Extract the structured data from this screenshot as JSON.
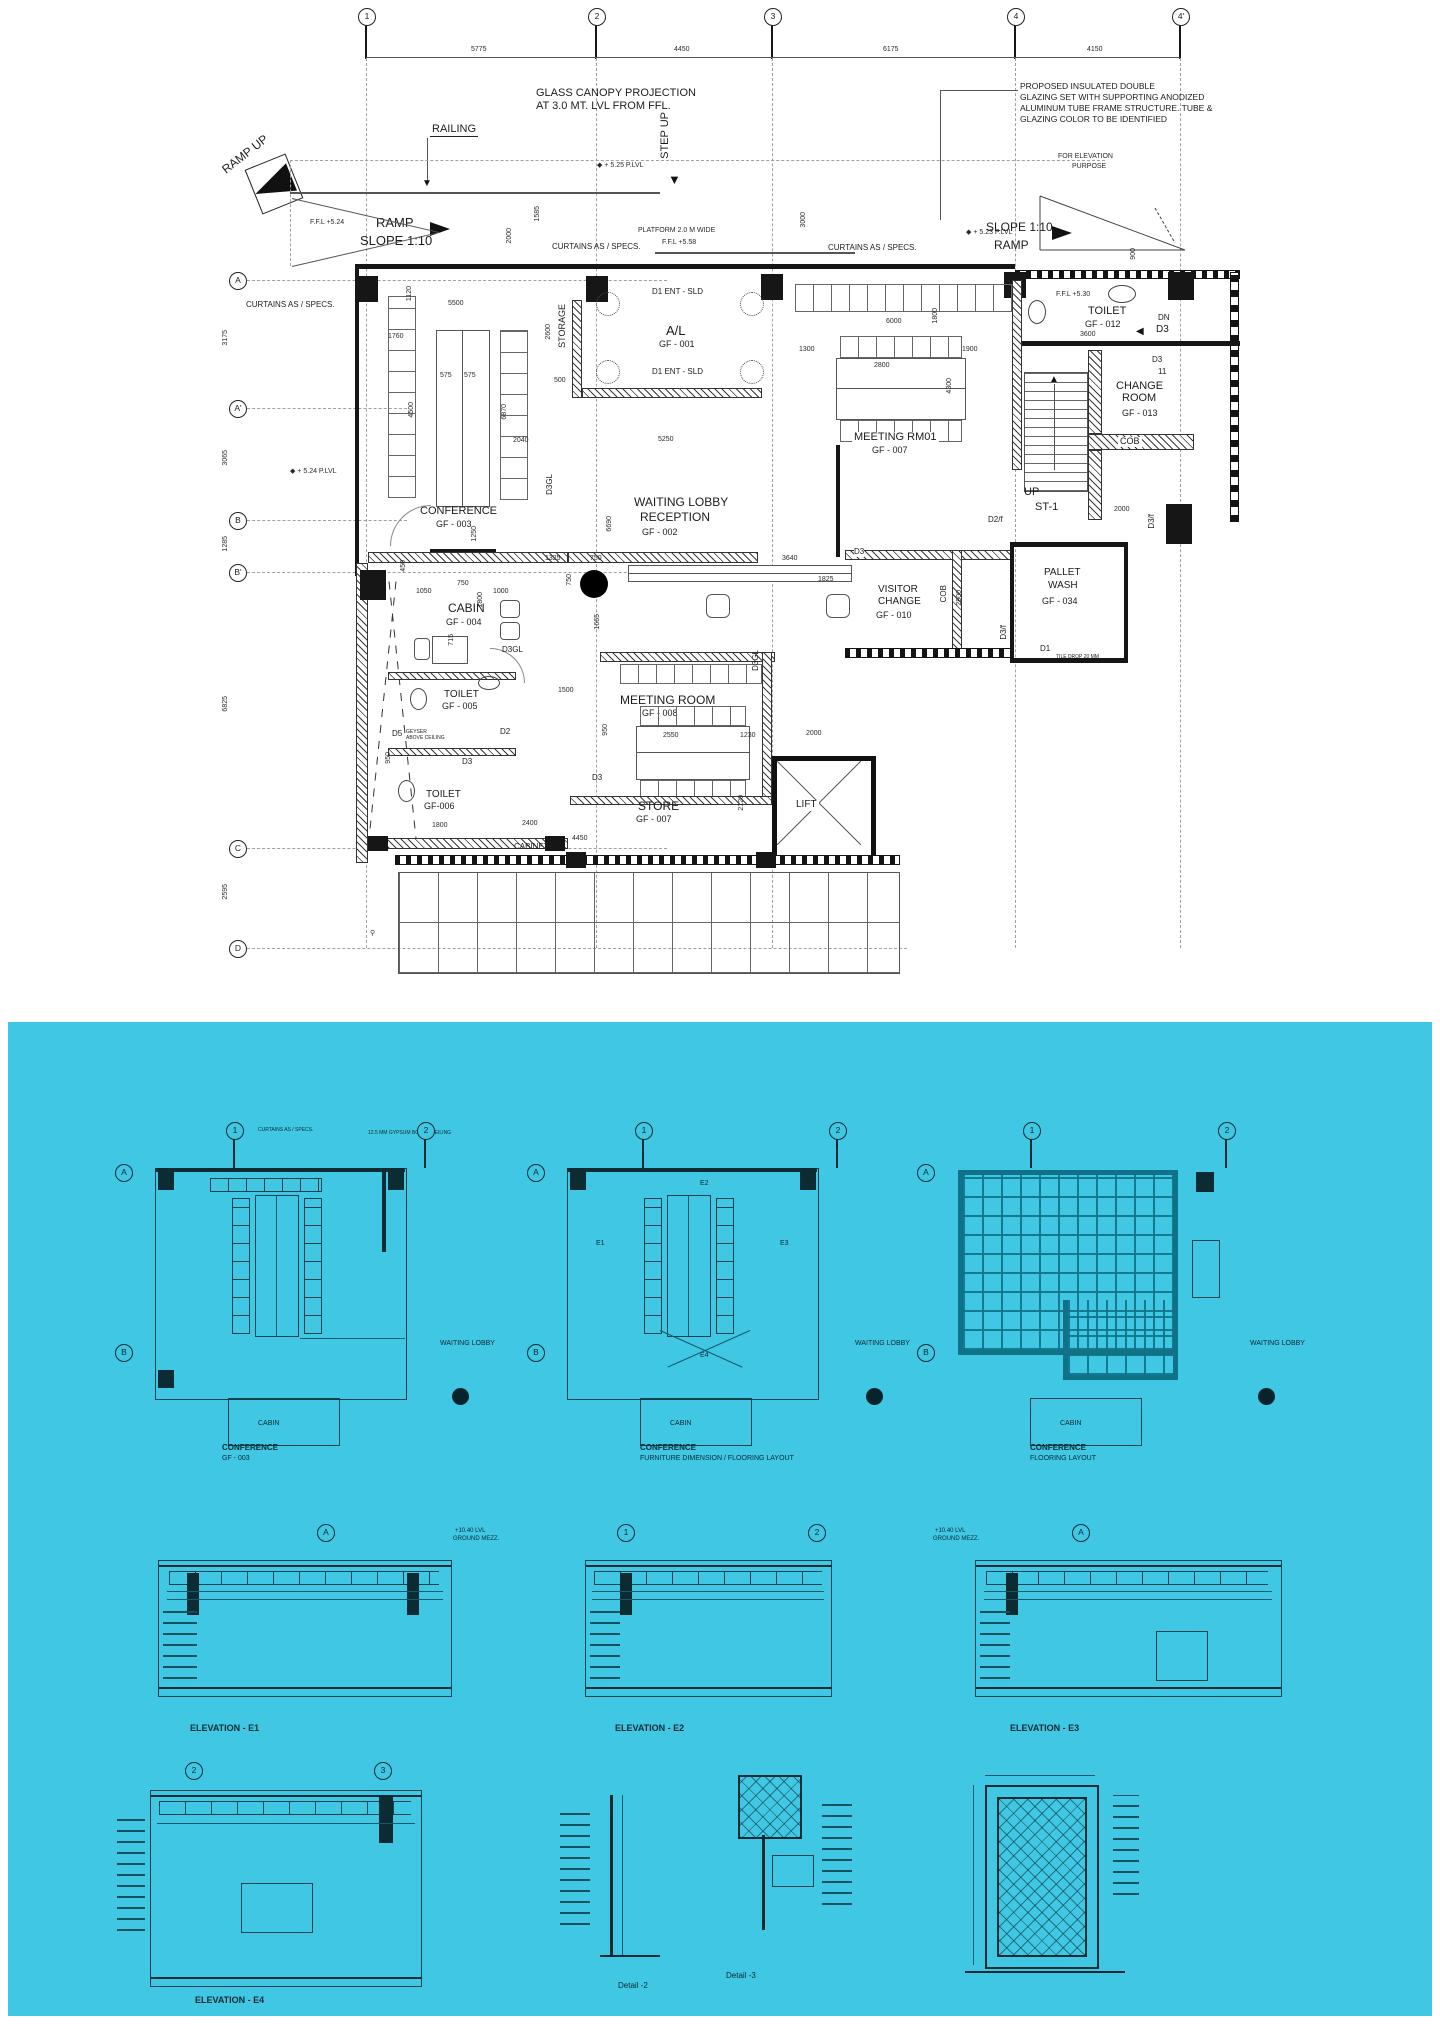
{
  "sheet": {
    "top_grid": {
      "b1": "1",
      "b2": "2",
      "b3": "3",
      "b4": "4",
      "b4a": "4'"
    },
    "top_dims": [
      "5775",
      "4450",
      "6175",
      "4150"
    ],
    "left_grid": {
      "a": "A",
      "a1": "A'",
      "b": "B",
      "b1": "B'",
      "c": "C",
      "d": "D"
    }
  },
  "annotations": {
    "ramp_up": "RAMP UP",
    "railing": "RAILING",
    "ramp": "RAMP",
    "slope": "SLOPE 1:10",
    "ffl524": "F.F.L +5.24",
    "plvl524": "+ 5.24 P.LVL",
    "plvl523": "+ 5.23 P.LVL",
    "plvl525": "+ 5.25 P.LVL",
    "glass1": "GLASS CANOPY PROJECTION",
    "glass2": "AT 3.0 MT. LVL FROM FFL.",
    "step_up": "STEP UP",
    "platform": "PLATFORM 2.0 M WIDE",
    "ffl558": "F.F.L +5.58",
    "curtains": "CURTAINS AS / SPECS.",
    "glazing1": "PROPOSED INSULATED DOUBLE",
    "glazing2": "GLAZING SET WITH SUPPORTING ANODIZED",
    "glazing3": "ALUMINUM TUBE FRAME STRUCTURE.  TUBE &",
    "glazing4": "GLAZING COLOR TO BE IDENTIFIED",
    "forelev1": "FOR ELEVATION",
    "forelev2": "PURPOSE",
    "ffl530": "F.F.L +5.30",
    "dn": "DN",
    "d3": "D3",
    "d3_11a": "D3",
    "d3_11b": "11",
    "cob": "COB",
    "up": "UP",
    "st1": "ST-1",
    "d2f": "D2/f",
    "d3f": "D3/f",
    "d1": "D1",
    "cabinets": "CABINETS",
    "geyser1": "GEYSER",
    "geyser2": "ABOVE CEILING",
    "tile_drop": "TILE DROP 20 MM",
    "storage": "STORAGE",
    "lift": "LIFT",
    "d1ent": "D1 ENT - SLD",
    "d3gl": "D3GL",
    "d2": "D2",
    "d5": "D5"
  },
  "rooms": {
    "al": {
      "n": "A/L",
      "i": "GF - 001"
    },
    "lobby": {
      "n1": "WAITING LOBBY",
      "n2": "RECEPTION",
      "i": "GF - 002"
    },
    "conference": {
      "n": "CONFERENCE",
      "i": "GF - 003"
    },
    "cabin": {
      "n": "CABIN",
      "i": "GF - 004"
    },
    "toilet5": {
      "n": "TOILET",
      "i": "GF - 005"
    },
    "toilet6": {
      "n": "TOILET",
      "i": "GF-006"
    },
    "meeting1": {
      "n": "MEETING RM01",
      "i": "GF - 007"
    },
    "meeting8": {
      "n": "MEETING ROOM",
      "i": "GF - 008"
    },
    "store": {
      "n": "STORE",
      "i": "GF - 007"
    },
    "visitor": {
      "n1": "VISITOR",
      "n2": "CHANGE",
      "i": "GF - 010"
    },
    "toilet12": {
      "n": "TOILET",
      "i": "GF - 012"
    },
    "change": {
      "n1": "CHANGE",
      "n2": "ROOM",
      "i": "GF - 013"
    },
    "pallet": {
      "n1": "PALLET",
      "n2": "WASH",
      "i": "GF - 034"
    }
  },
  "dims": [
    "5775",
    "4450",
    "6175",
    "4150",
    "3175",
    "3065",
    "1285",
    "6825",
    "2595",
    "5500",
    "1120",
    "1760",
    "575",
    "575",
    "4500",
    "2600",
    "500",
    "2040",
    "6870",
    "5250",
    "1585",
    "2000",
    "3000",
    "900",
    "6000",
    "1800",
    "1300",
    "2800",
    "1900",
    "4300",
    "1325",
    "750",
    "3640",
    "750",
    "1825",
    "6690",
    "1665",
    "1050",
    "750",
    "1000",
    "1800",
    "715",
    "450",
    "1250",
    "3600",
    "2000",
    "2900",
    "2550",
    "1230",
    "2000",
    "950",
    "1500",
    "2400",
    "4450",
    "2120",
    "1800",
    "950"
  ],
  "sheet2": {
    "waiting_lobby": "WAITING LOBBY",
    "cabin": "CABIN",
    "bubbles": {
      "one": "1",
      "two": "2",
      "three": "3",
      "a": "A",
      "b": "B"
    },
    "captions": {
      "p1a": "CONFERENCE",
      "p1b": "GF - 003",
      "p2a": "CONFERENCE",
      "p2b": "FURNITURE DIMENSION  / FLOORING LAYOUT",
      "p3a": "CONFERENCE",
      "p3b": "FLOORING LAYOUT",
      "e1": "ELEVATION - E1",
      "e2": "ELEVATION - E2",
      "e3": "ELEVATION - E3",
      "e4": "ELEVATION - E4",
      "d2": "Detail -2",
      "d3": "Detail -3"
    },
    "notes": {
      "curtains": "CURTAINS AS / SPECS.",
      "gypsum": "12.5 MM GYPSUM BOARD CEILING",
      "lvl": "+10.40 LVL",
      "mezz": "GROUND MEZZ.",
      "e1": "E1",
      "e2": "E2",
      "e3": "E3",
      "e4": "E4"
    }
  }
}
